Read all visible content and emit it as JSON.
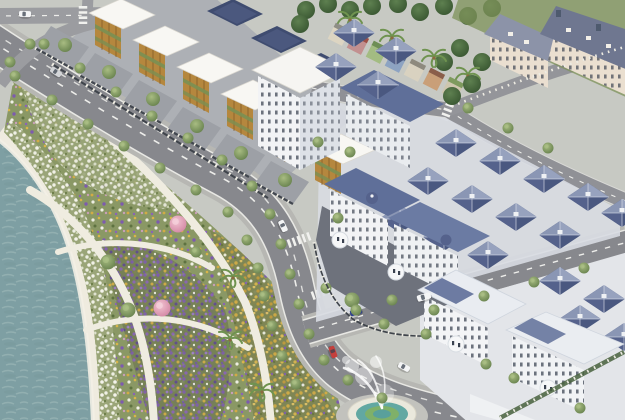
{
  "scene": {
    "type": "architectural-aerial-render",
    "title": "Waterfront residential masterplan — aerial 3D render",
    "description": "Aerial rendering of a coastal residential development: a teal lake edged by a white stone promenade borders a crescent flower park with winding paths, palm trees and pink blossom trees; a tree-lined boulevard separates the park from a row of modern shophouses with golden timber-louvre facades and white slab roofs; behind them sit navy panelled roofs and a colorful back street of small row houses; a grand grey-roofed classical mansion anchors the top right; a dense grid of white villas with slate-blue hip roofs fills the right side; ornate white classical villas stand at the center and bottom right; cars travel the roads and a fountain sprays beside the bottom plaza.",
    "landmarks": [
      "lake",
      "promenade",
      "flower-park",
      "boulevard",
      "shophouse-row",
      "solar-roof-row",
      "back-street-houses",
      "grand-mansion",
      "villa-grid",
      "classical-villas",
      "fountain-plaza"
    ],
    "vehicles": [
      {
        "color": "white"
      },
      {
        "color": "silver"
      },
      {
        "color": "white"
      },
      {
        "color": "dark-blue"
      },
      {
        "color": "red"
      },
      {
        "color": "white"
      },
      {
        "color": "white-van"
      }
    ]
  },
  "palette": {
    "ground": "#C7C9C3",
    "water": "#7E9FA3",
    "foam": "#F3F0E6",
    "promenade": "#E6E1D3",
    "park_path": "#EFECE0",
    "road_asphalt": "#87888D",
    "road_minor": "#909196",
    "road_sidewalk": "#B7B7B3",
    "lane_dash": "#EDEDEA",
    "block_base": "#ADB0B5",
    "grid_base": "#D8DBE2",
    "townhouse_roof": "#F8F7F3",
    "facade_wood": "#B5873E",
    "terrace_green": "#7C8F52",
    "courtyard_paving": "#9DA0A6",
    "fence_post": "#EDEBE2",
    "solar_roof": "#3F4C70",
    "villa_wall": "#F2F3F5",
    "villa_roof": "#5F6F99",
    "mansion_wall": "#EADFD0",
    "mansion_roof": "#8C93A8",
    "mansion_roof_dark": "#6F7790",
    "lawn_green": "#7E9159",
    "fountain_water": "#62A8A2",
    "fountain_ring": "#7FB069",
    "fountain_rim": "#EAE8DC",
    "car_white": "#F4F5F6",
    "car_silver": "#D3D5D8",
    "car_blue": "#2E4090",
    "car_red": "#C43F3C"
  }
}
